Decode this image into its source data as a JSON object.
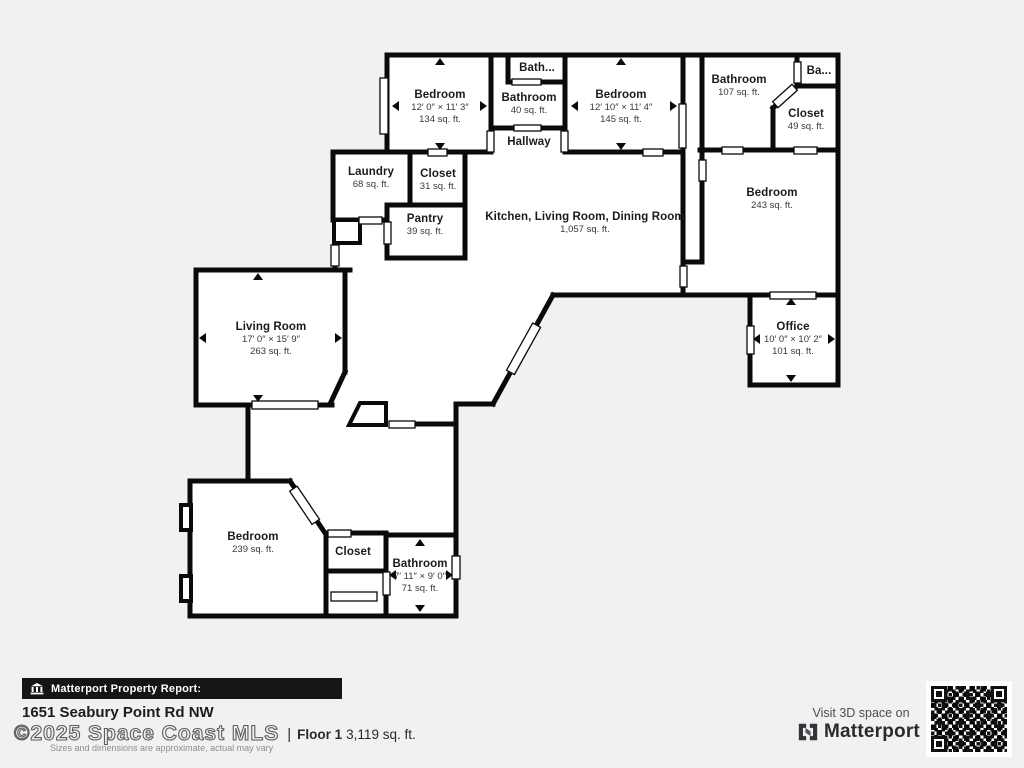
{
  "floorplan": {
    "rooms": [
      {
        "name": "Bedroom",
        "dims": "12′ 0″ × 11′ 3″",
        "area": "134 sq. ft."
      },
      {
        "name": "Bath..."
      },
      {
        "name": "Bathroom",
        "area": "40 sq. ft."
      },
      {
        "name": "Hallway"
      },
      {
        "name": "Bedroom",
        "dims": "12′ 10″ × 11′ 4″",
        "area": "145 sq. ft."
      },
      {
        "name": "Bathroom",
        "area": "107 sq. ft."
      },
      {
        "name": "Ba..."
      },
      {
        "name": "Closet",
        "area": "49 sq. ft."
      },
      {
        "name": "Laundry",
        "area": "68 sq. ft."
      },
      {
        "name": "Closet",
        "area": "31 sq. ft."
      },
      {
        "name": "Pantry",
        "area": "39 sq. ft."
      },
      {
        "name": "Kitchen, Living Room, Dining Room",
        "area": "1,057 sq. ft."
      },
      {
        "name": "Bedroom",
        "area": "243 sq. ft."
      },
      {
        "name": "Office",
        "dims": "10′ 0″ × 10′ 2″",
        "area": "101 sq. ft."
      },
      {
        "name": "Living Room",
        "dims": "17′ 0″ × 15′ 9″",
        "area": "263 sq. ft."
      },
      {
        "name": "Bedroom",
        "area": "239 sq. ft."
      },
      {
        "name": "Closet"
      },
      {
        "name": "Bathroom",
        "dims": "7′ 11″ × 9′ 0″",
        "area": "71 sq. ft."
      }
    ]
  },
  "footer": {
    "report_label": "Matterport Property Report:",
    "address": "1651 Seabury Point Rd NW",
    "watermark": "©2025 Space Coast MLS",
    "separator": "|",
    "floor_label": "Floor 1",
    "floor_area": "3,119 sq. ft.",
    "disclaimer": "Sizes and dimensions are approximate, actual may vary",
    "cta": "Visit 3D space on",
    "brand": "Matterport"
  },
  "colors": {
    "background": "#f1f1ef",
    "wall": "#0a0a0a",
    "interior": "#ffffff",
    "bar": "#151515"
  }
}
